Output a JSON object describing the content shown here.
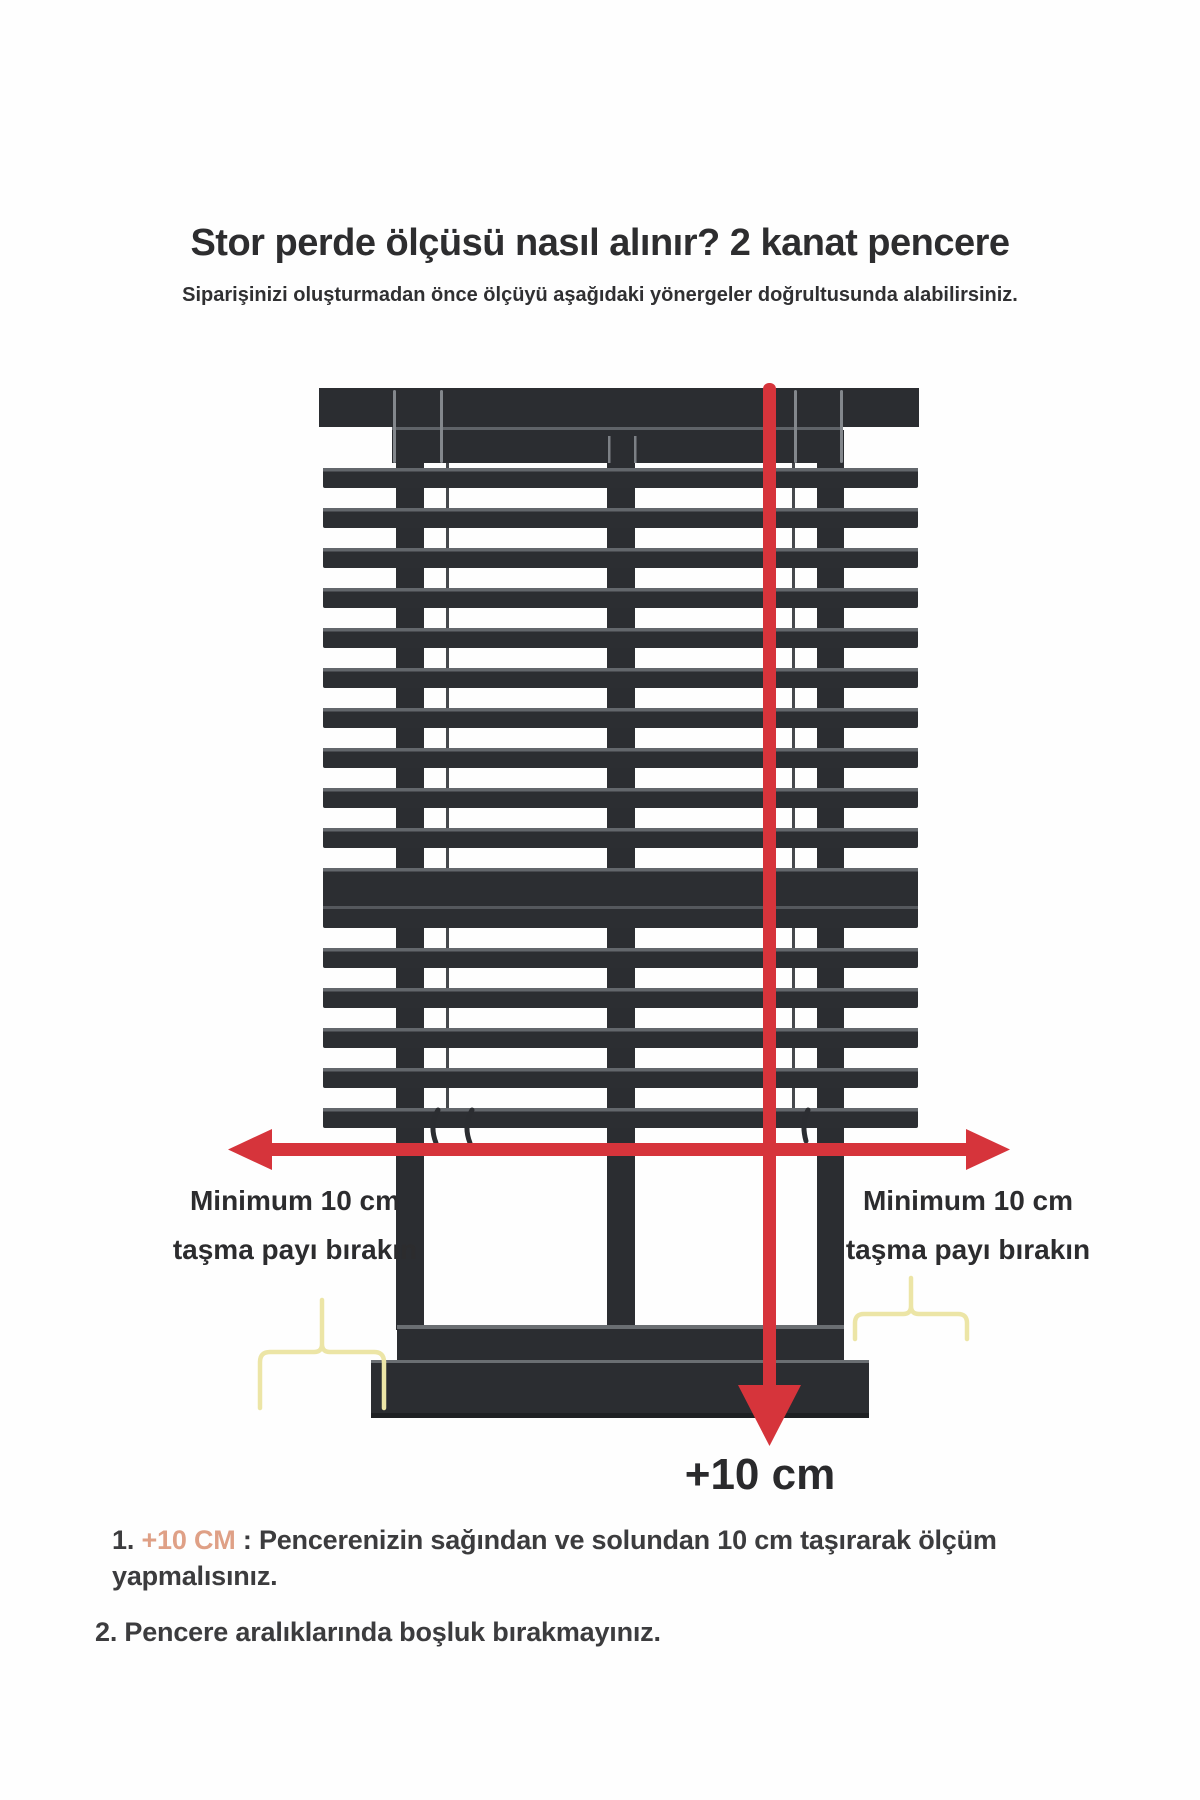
{
  "header": {
    "title": "Stor perde ölçüsü nasıl alınır? 2 kanat pencere",
    "subtitle": "Siparişinizi oluşturmadan önce ölçüyü aşağıdaki yönergeler doğrultusunda alabilirsiniz."
  },
  "diagram": {
    "left_overflow_label": {
      "line1": "Minimum 10 cm",
      "line2": "taşma payı bırakın"
    },
    "right_overflow_label": {
      "line1": "Minimum 10 cm",
      "line2": "taşma payı bırakın"
    },
    "height_measure_label": "+10 cm",
    "icons": {
      "width_arrow": "double-headed-horizontal-measure-arrow",
      "height_arrow": "downward-vertical-measure-arrow",
      "left_bracket": "overflow-range-bracket",
      "right_bracket": "overflow-range-bracket"
    },
    "colors": {
      "frame_dark": "#2b2d31",
      "slat_dark": "#2c2e32",
      "slat_edge_gray": "#63676c",
      "outline_gray": "#83878c",
      "arrow_red": "#d6343b",
      "bracket_yellow": "#ece5a6",
      "text_dark": "#2c2c2e"
    }
  },
  "footer": {
    "item1_number": "1.",
    "item1_highlight": "+10 CM",
    "item1_separator": " : ",
    "item1_text": "Pencerenizin sağından ve solundan 10 cm taşırarak ölçüm yapmalısınız.",
    "item2": "2. Pencere aralıklarında boşluk bırakmayınız.",
    "highlight_color": "#dfa086"
  }
}
